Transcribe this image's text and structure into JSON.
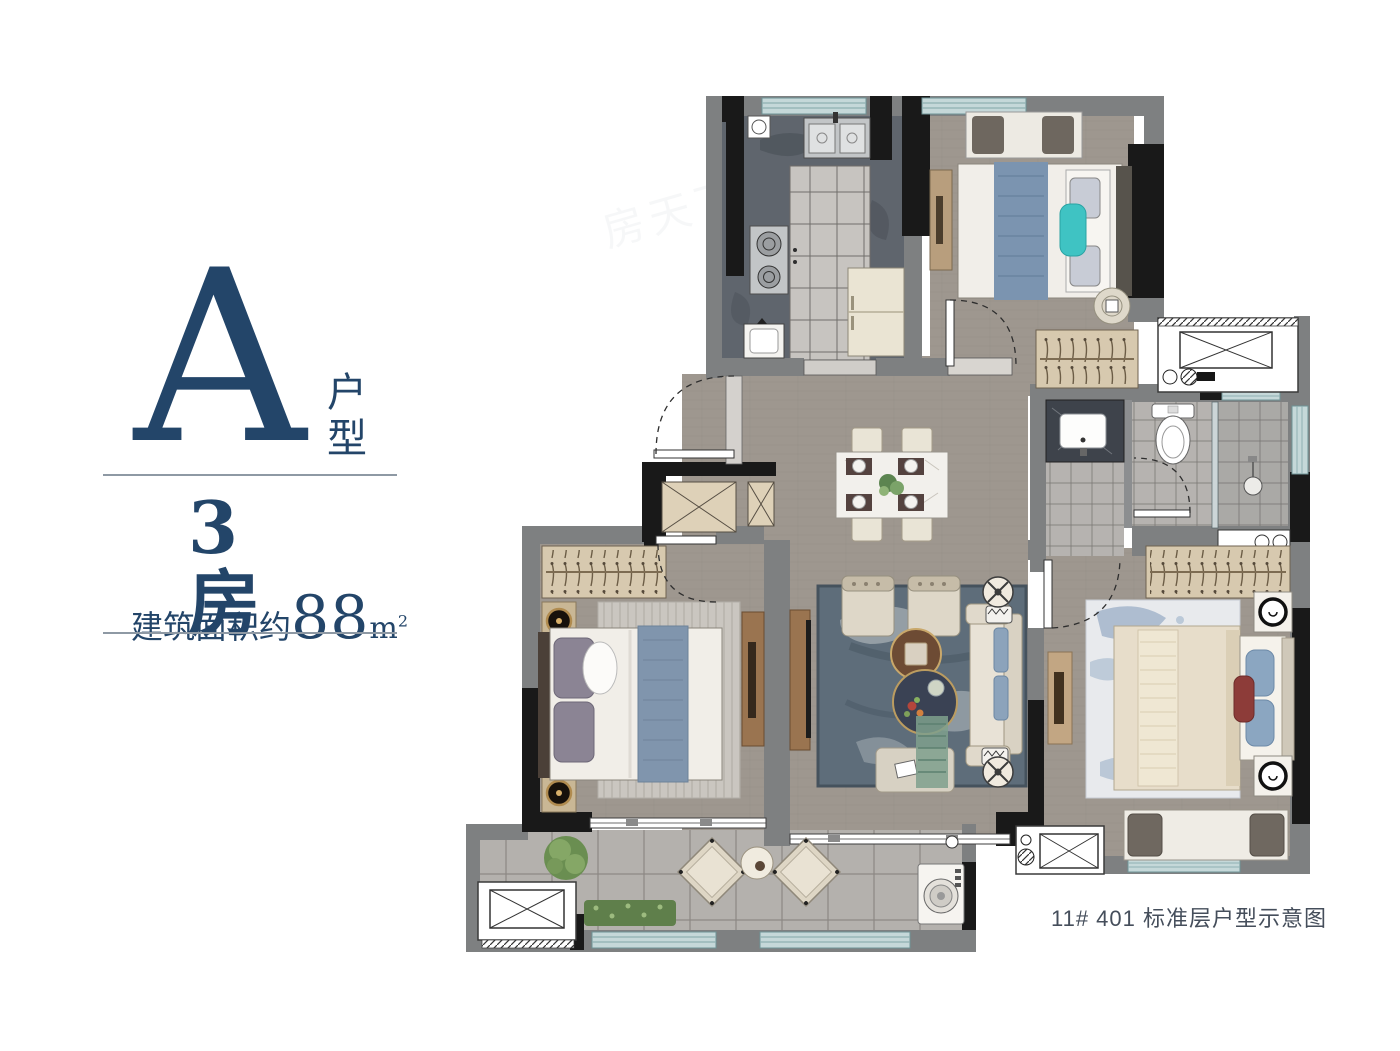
{
  "panel": {
    "unit_letter": "A",
    "unit_label": "户型",
    "rooms_label": "3房",
    "area_prefix": "建筑面积约",
    "area_number": "88",
    "area_unit": "m",
    "area_exponent": "2"
  },
  "caption": {
    "text": "11# 401 标准层户型示意图"
  },
  "watermark": {
    "text": "房天下"
  },
  "colors": {
    "navy_text": "#234569",
    "caption_text": "#454e5b",
    "wall_gray": "#7e8081",
    "wall_black": "#191919",
    "window_teal": "#c5d8d9",
    "wood_floor": "#9e978f",
    "kitchen_counter": "#5f656d",
    "wardrobe_tan": "#d7c9ae",
    "accent_blue": "#8095ad",
    "accent_teal_pillow": "#3fc3c3"
  }
}
